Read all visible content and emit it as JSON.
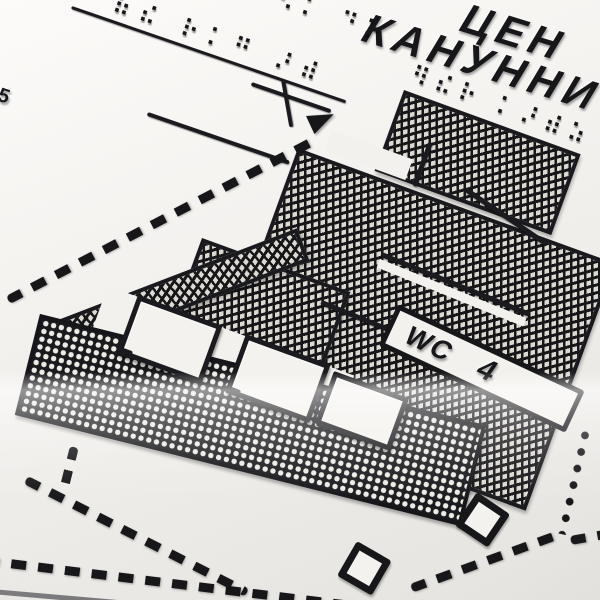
{
  "signage": {
    "title_line1": "ЦЕН",
    "title_line2": "КАНУННИ",
    "room_number_left": "5",
    "wc_label": "WC",
    "wc_room_number": "4"
  },
  "braille": {
    "row_top_edge": "⠪⠅ ⠙⠕",
    "row_upper": "⠷⠮ ⠗⠅⠛ ⠜⠾",
    "row_under_title": "⠻⠮⠗ ⠅⠜⠾⠵"
  },
  "symbols": {
    "diamond_marker_count": 2,
    "direction_arrow": "up-right"
  },
  "colors": {
    "plate": "#f3f1ed",
    "emboss_dark": "#17171a",
    "hatch_base": "#dcd9d3",
    "mesh_base": "#1a1a1e"
  }
}
